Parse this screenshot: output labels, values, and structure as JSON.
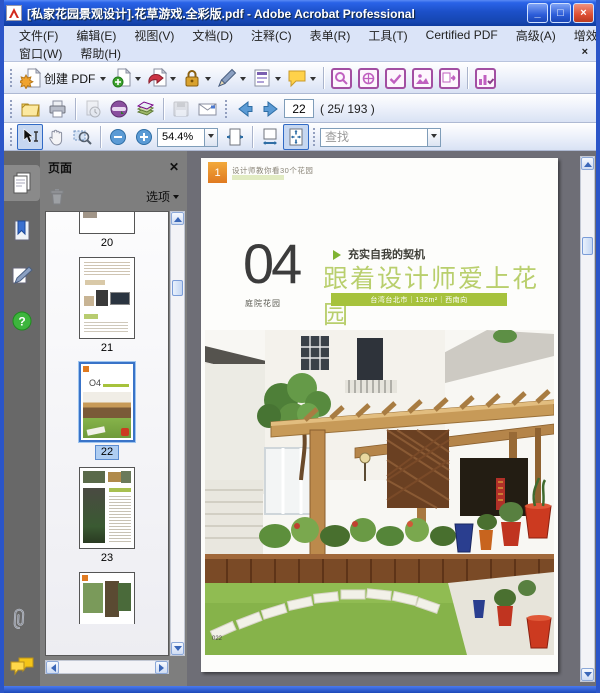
{
  "window": {
    "title": "[私家花园景观设计].花草游戏.全彩版.pdf - Adobe Acrobat Professional",
    "minimize": "_",
    "maximize": "□",
    "close": "×"
  },
  "menubar": {
    "row1": [
      "文件(F)",
      "编辑(E)",
      "视图(V)",
      "文档(D)",
      "注释(C)",
      "表单(R)",
      "工具(T)",
      "Certified PDF",
      "高级(A)",
      "增效工具(P)"
    ],
    "row2": [
      "窗口(W)",
      "帮助(H)"
    ],
    "close_glyph": "×"
  },
  "toolbars": {
    "create_pdf": "创建 PDF",
    "page_value": "22",
    "page_count": "( 25/ 193 )",
    "zoom_value": "54.4%",
    "find_placeholder": "查找"
  },
  "sidebar": {
    "panel_title": "页面",
    "options_label": "选项",
    "thumb_labels": [
      "20",
      "21",
      "22",
      "23",
      "24"
    ],
    "selected_page": "22"
  },
  "page": {
    "header_text": "设计师教你看30个花园",
    "part_badge": "1",
    "chapter_number": "04",
    "chapter_label": "庭院花园",
    "tagline": "充实自我的契机",
    "title": "跟着设计师爱上花园",
    "info_bar": "台湾台北市｜132m²｜西南向",
    "page_number": "022"
  },
  "colors": {
    "titlebar_blue": "#1c50c8",
    "accent_green": "#a6c23c",
    "title_green": "#b9cf6d",
    "selection_blue": "#316ac5",
    "plugin_purple": "#a24fa2"
  }
}
